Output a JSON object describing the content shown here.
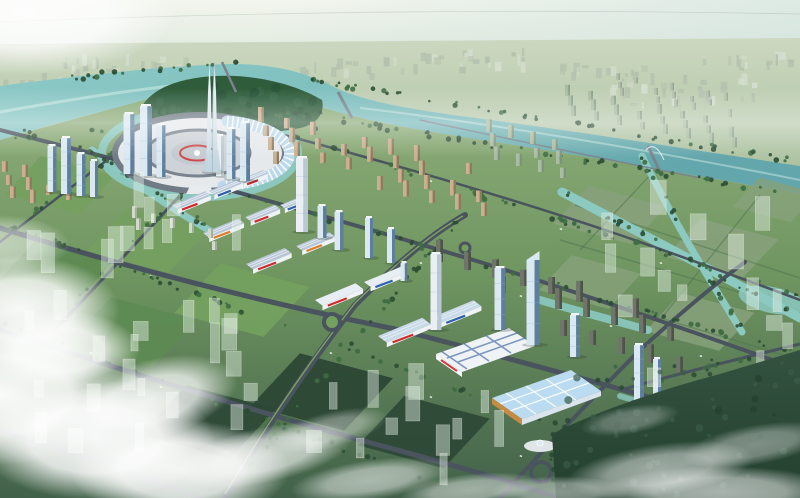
{
  "meta": {
    "type": "architectural-aerial-rendering",
    "width_px": 800,
    "height_px": 498
  },
  "scene": {
    "title": "Aerial master-plan rendering of a new city district",
    "description": "Bird's-eye 3D rendering of a planned city district on a winding teal river: a circular central plaza ringed by a canal holds a twin-pronged white spire skyscraper and a curved glass hall; glass office towers cluster around it; diagonal rows of white trade-market halls with red signage step toward large blue-roofed exhibition halls with orange trim; tan and grey residential slab rows line the river; a diamond grid of tree-lined roads divides green blocks; translucent future-phase massings fade into hazy distance while white clouds drift across the foreground.",
    "landmarks": [
      {
        "name": "central-spire-tower",
        "label": "Twin-pronged white spire skyscraper"
      },
      {
        "name": "ring-plaza",
        "label": "Circular central plaza"
      },
      {
        "name": "crescent-glass-hall",
        "label": "Curved glass hall on plaza ring"
      },
      {
        "name": "river",
        "label": "Winding teal river"
      },
      {
        "name": "river-island-park",
        "label": "Riverside tree park"
      },
      {
        "name": "market-hall-rows",
        "label": "Rows of white trade halls with red signs"
      },
      {
        "name": "exhibition-halls",
        "label": "Blue-roofed exhibition halls with orange trim"
      },
      {
        "name": "office-towers",
        "label": "Glass office towers"
      },
      {
        "name": "residential-rows",
        "label": "Residential slab housing rows"
      },
      {
        "name": "green-blocks",
        "label": "Planted city blocks and fields"
      },
      {
        "name": "future-phase-ghosts",
        "label": "Translucent future-phase building massing"
      },
      {
        "name": "foreground-clouds",
        "label": "White clouds over the foreground"
      },
      {
        "name": "distant-city",
        "label": "Hazy distant city sprawl"
      }
    ]
  },
  "palette": {
    "sky_top": "#f3f6ee",
    "sky_mid": "#dde8dd",
    "sky_low": "#c3d4c3",
    "sky_right": "#cfe2dd",
    "far_hi": "#ccd8c0",
    "far_lo": "#a9c09e",
    "far_city": "#b2c0ad",
    "far_city_hi": "#d6dfd0",
    "river": "#7fc0bf",
    "river_deep": "#63a6ab",
    "river_hi": "#d8efe8",
    "canal": "#8cc9c1",
    "ground_hi": "#8fae7a",
    "ground_mid": "#6f9560",
    "ground_lo": "#42614a",
    "block_bright": "#74a05f",
    "block_mid": "#5d8a52",
    "block_dark": "#39593f",
    "block_deep": "#2c4735",
    "field_right": "#87a17b",
    "hedge": "#4e7450",
    "island_tree": "#2f5c3b",
    "tree": "#3e6b42",
    "tree_dark": "#2b4d33",
    "road": "#49545e",
    "road_light": "#79848e",
    "white_bldg": "#eff3f6",
    "roof_grey": "#b7c6d6",
    "roof_ridge": "#e9eff5",
    "sign_red": "#cf2a2e",
    "sign_orange": "#e07b28",
    "sign_blue": "#2f5fae",
    "exhib_roof": "#badbf0",
    "trim_orange": "#c78a42",
    "stripe_blue": "#5577a8",
    "glass_light": "#d9e8f1",
    "glass": "#8fb3cd",
    "glass_dark": "#5d7f9d",
    "spire_hi": "#f4f8fa",
    "spire_lo": "#c2d4de",
    "tan": "#c9b190",
    "tan_dark": "#8f7a5e",
    "resid_green": "#a9bda2",
    "slab": "#6f7569",
    "slab_dark": "#4d5349",
    "ghost_fill": "rgba(226,239,229,0.45)",
    "ghost_edge": "rgba(255,255,255,0.40)",
    "cloud": "#ffffff",
    "forest": "#33523f",
    "forest_deep": "#24402f",
    "plaza_ring": "#707b86",
    "plaza_inner": "#e6e9ec",
    "plaza_core": "#ced3d7",
    "arc_bldg": "#bcd9ec"
  }
}
